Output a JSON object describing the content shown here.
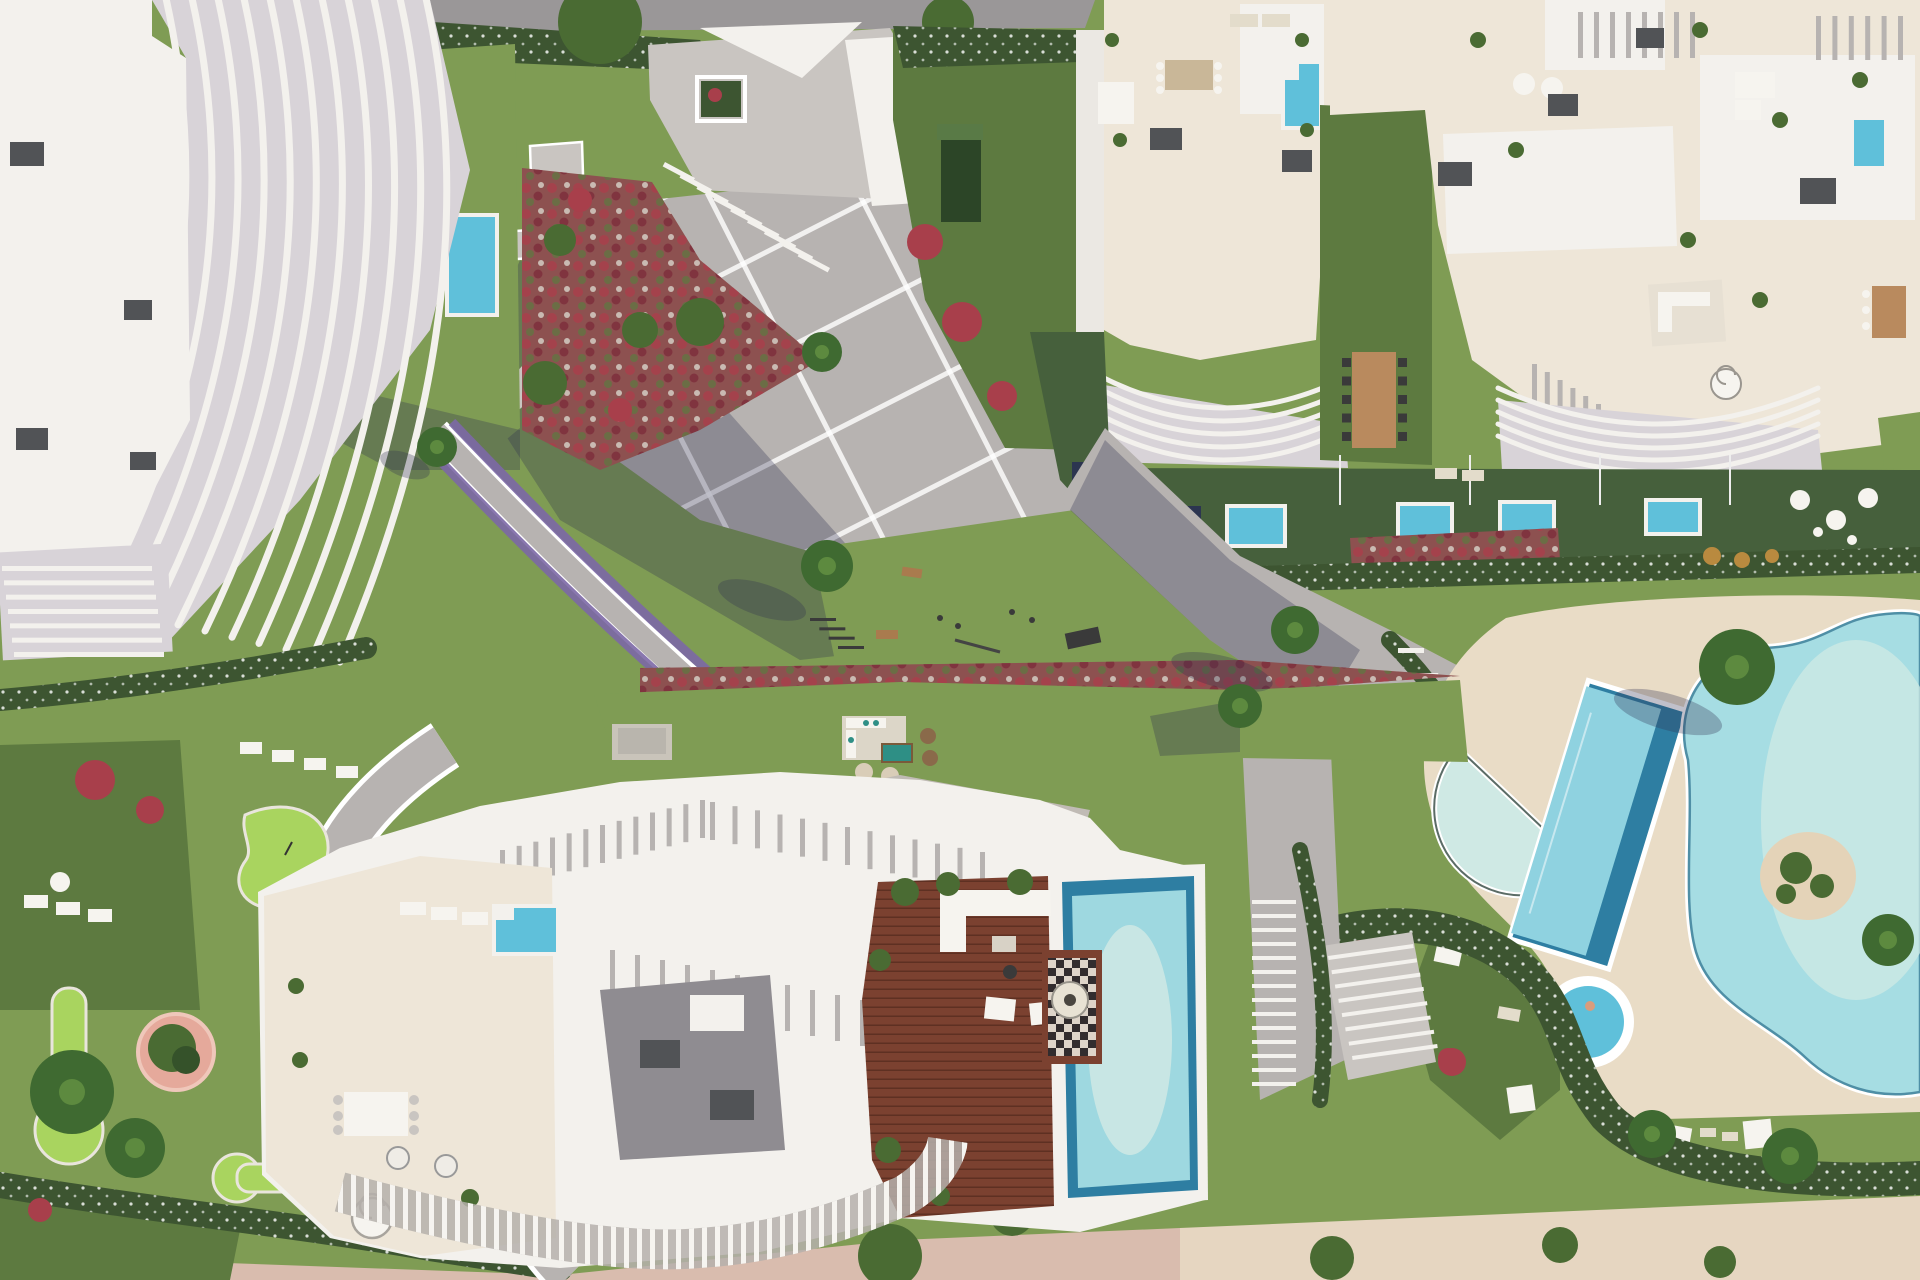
{
  "meta": {
    "title": "Aerial masterplan rendering of a coastal residential resort",
    "width": 1920,
    "height": 1280
  },
  "palette": {
    "grass": "#7f9c54",
    "grassDark": "#5d7a40",
    "grassShadow": "#46603c",
    "putting": "#a9d45f",
    "hedge": "#3d5531",
    "treeGreen": "#4a6b33",
    "palm": "#3f6a31",
    "paving": "#b7b3b1",
    "pavingLight": "#c9c5c1",
    "road": "#9a9798",
    "white": "#f3f1ed",
    "cream": "#eee6d8",
    "deckSand": "#e9dcc6",
    "roofBox": "#515356",
    "poolAqua": "#5fc0da",
    "poolDeep": "#2e7ea2",
    "poolLagoon": "#a6dde3",
    "poolPale": "#cfe9e4",
    "wood": "#7b4130",
    "red": "#a83f4b",
    "purple": "#7c68a6",
    "sandPink": "#d9bcae",
    "sand": "#e6d6c1",
    "furn": "#f6f4ef"
  },
  "scene": {
    "regions": [
      {
        "id": "west-tower",
        "label": "West residence with sculpted curved fin balconies"
      },
      {
        "id": "north-road",
        "label": "Street along the top edge"
      },
      {
        "id": "entrance-courtyard",
        "label": "Entrance courtyard with square planter and canopies"
      },
      {
        "id": "central-plaza",
        "label": "Diagonal paved promenade with white banding"
      },
      {
        "id": "outdoor-gym-lawn",
        "label": "Lawn with outdoor gym equipment"
      },
      {
        "id": "northeast-complex",
        "label": "North-east residences with rooftop terraces and plunge pools"
      },
      {
        "id": "green-alley",
        "label": "Garden alley with communal dining table"
      },
      {
        "id": "private-gardens",
        "label": "Ground-floor gardens with private plunge pools"
      },
      {
        "id": "amenity-pool-deck",
        "label": "Amenity deck with lap pool, half-moon pool and spa"
      },
      {
        "id": "lagoon-pool",
        "label": "Free-form lagoon pool with planted island"
      },
      {
        "id": "south-building",
        "label": "South residence with wavy pergola, timber deck and rooftop pool"
      },
      {
        "id": "mini-golf-garden",
        "label": "Putting-green garden with winding path"
      },
      {
        "id": "beach-promenade",
        "label": "Sandy seafront promenade along the bottom edge"
      }
    ]
  }
}
